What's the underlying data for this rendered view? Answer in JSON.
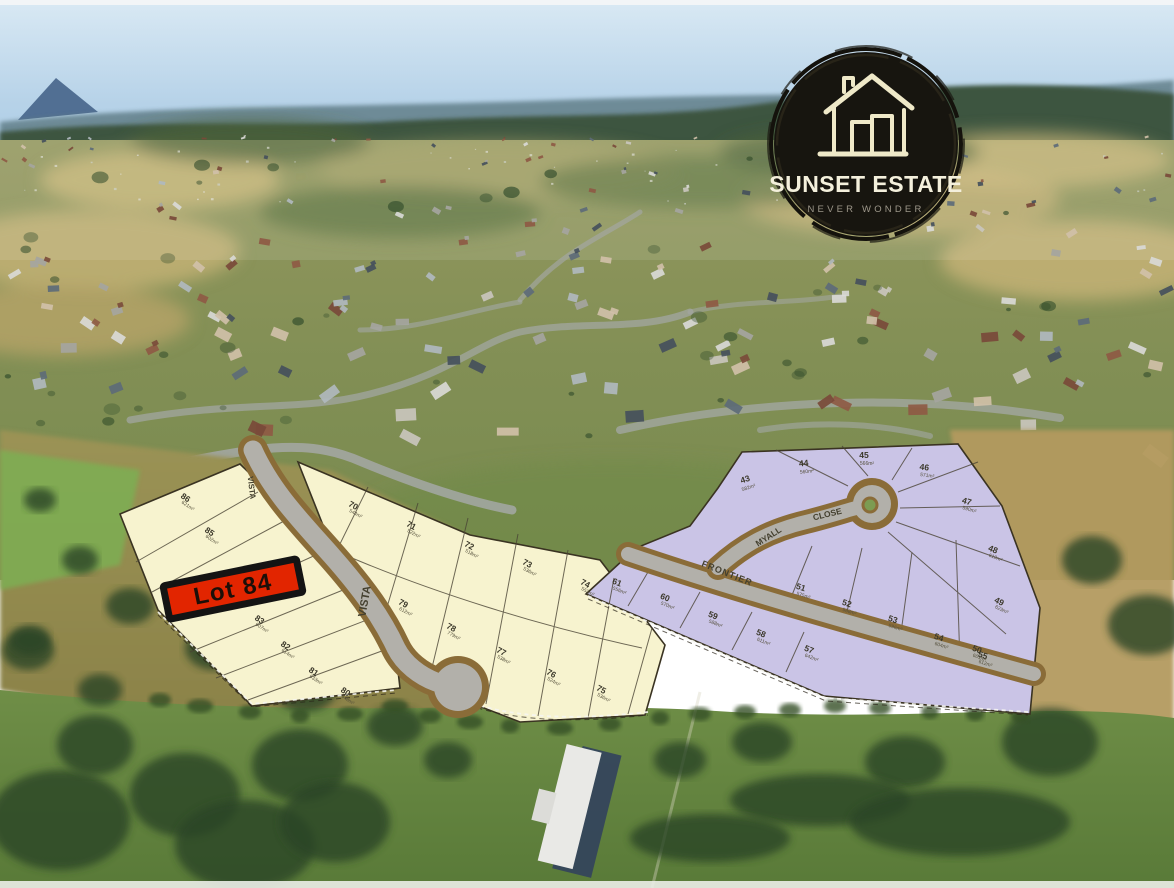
{
  "branding": {
    "logo_title": "SUNSET ESTATE",
    "logo_tagline": "NEVER WONDER",
    "logo_icon": "house-icon",
    "logo_bg": "#17150f",
    "logo_text_color": "#f2eedb"
  },
  "highlight": {
    "label": "Lot 84",
    "bg": "#e22500",
    "border": "#141414"
  },
  "streets": {
    "vista": "VISTA",
    "myall": "MYALL",
    "close": "CLOSE",
    "frontier": "FRONTIER"
  },
  "estate": {
    "sections": [
      {
        "id": "yellow-west",
        "color": "#f7f3cf",
        "lots": [
          {
            "num": "86",
            "area": "621m²"
          },
          {
            "num": "85",
            "area": "602m²"
          },
          {
            "num": "84",
            "area": ""
          },
          {
            "num": "83",
            "area": "607m²"
          },
          {
            "num": "82",
            "area": "614m²"
          },
          {
            "num": "81",
            "area": "633m²"
          },
          {
            "num": "80",
            "area": "648m²"
          }
        ]
      },
      {
        "id": "yellow-east",
        "color": "#f7f3cf",
        "lots": [
          {
            "num": "70",
            "area": "544m²"
          },
          {
            "num": "71",
            "area": "522m²"
          },
          {
            "num": "72",
            "area": "518m²"
          },
          {
            "num": "73",
            "area": "536m²"
          },
          {
            "num": "74",
            "area": "552m²"
          },
          {
            "num": "75",
            "area": "536m²"
          },
          {
            "num": "76",
            "area": "524m²"
          },
          {
            "num": "77",
            "area": "538m²"
          },
          {
            "num": "78",
            "area": "779m²"
          },
          {
            "num": "79",
            "area": "612m²"
          }
        ]
      },
      {
        "id": "purple-ridge",
        "color": "#cac4e6",
        "lots": [
          {
            "num": "43",
            "area": "582m²"
          },
          {
            "num": "44",
            "area": "560m²"
          },
          {
            "num": "45",
            "area": "566m²"
          },
          {
            "num": "46",
            "area": "571m²"
          },
          {
            "num": "47",
            "area": "590m²"
          },
          {
            "num": "48",
            "area": "610m²"
          },
          {
            "num": "49",
            "area": "623m²"
          },
          {
            "num": "50",
            "area": "601m²"
          }
        ]
      },
      {
        "id": "purple-mid",
        "color": "#cac4e6",
        "lots": [
          {
            "num": "51",
            "area": "575m²"
          },
          {
            "num": "52",
            "area": "588m²"
          },
          {
            "num": "53",
            "area": "596m²"
          },
          {
            "num": "54",
            "area": "604m²"
          },
          {
            "num": "55",
            "area": "612m²"
          }
        ]
      },
      {
        "id": "purple-wedge",
        "color": "#cac4e6",
        "lots": [
          {
            "num": "61",
            "area": "556m²"
          },
          {
            "num": "60",
            "area": "570m²"
          },
          {
            "num": "59",
            "area": "588m²"
          },
          {
            "num": "58",
            "area": "611m²"
          },
          {
            "num": "57",
            "area": "642m²"
          }
        ]
      }
    ]
  },
  "palette": {
    "sky_top": "#d3e5f2",
    "sky_bottom": "#a9cbe4",
    "mountain": "#46648a",
    "tree_ridge": "#3c5440",
    "field_olive": "#958c52",
    "field_green": "#6d8c46",
    "field_gold": "#b49a5e",
    "lot_yellow": "#f7f3cf",
    "lot_purple": "#cac4e6",
    "road_gray": "#b2b0aa",
    "road_dirt": "#8a6c38",
    "highlight_red": "#e22500",
    "logo_bg": "#17150f",
    "logo_cream": "#efe9c8"
  }
}
